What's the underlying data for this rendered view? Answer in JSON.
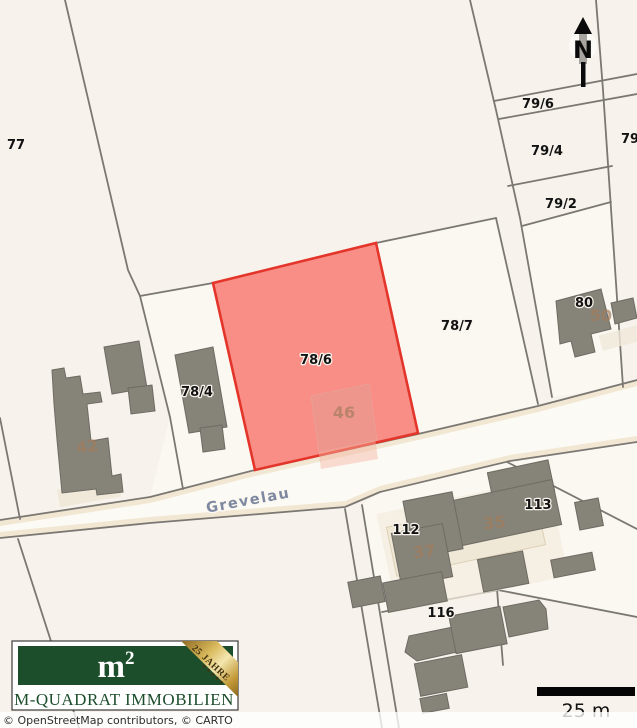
{
  "map": {
    "background": "#f7f3ec",
    "boundary_color": "#7b7772",
    "street": {
      "name": "Grevelau",
      "fill": "#f1e7d2"
    },
    "highlight_parcel": {
      "id": "78/6",
      "fill": "#f88e86",
      "border": "#e4352b"
    },
    "parcel_labels": [
      {
        "text": "77"
      },
      {
        "text": "78/4"
      },
      {
        "text": "78/6"
      },
      {
        "text": "78/7"
      },
      {
        "text": "79/6"
      },
      {
        "text": "79/4"
      },
      {
        "text": "79/2"
      },
      {
        "text": "79"
      },
      {
        "text": "80"
      },
      {
        "text": "112"
      },
      {
        "text": "113"
      },
      {
        "text": "116"
      }
    ],
    "house_numbers": [
      {
        "text": "42"
      },
      {
        "text": "46"
      },
      {
        "text": "50"
      },
      {
        "text": "37"
      },
      {
        "text": "35"
      }
    ],
    "north_arrow": {
      "label": "N"
    }
  },
  "scale_bar": {
    "label": "25 m"
  },
  "attribution": {
    "text": "© OpenStreetMap contributors, © CARTO"
  },
  "logo": {
    "symbol_base": "m",
    "symbol_exponent": "2",
    "company": "M-QUADRAT IMMOBILIEN",
    "ribbon_text": "25 JAHRE",
    "ribbon_stars": "★★★★★",
    "green": "#1c4e2c",
    "gold": "#d9b95c"
  }
}
